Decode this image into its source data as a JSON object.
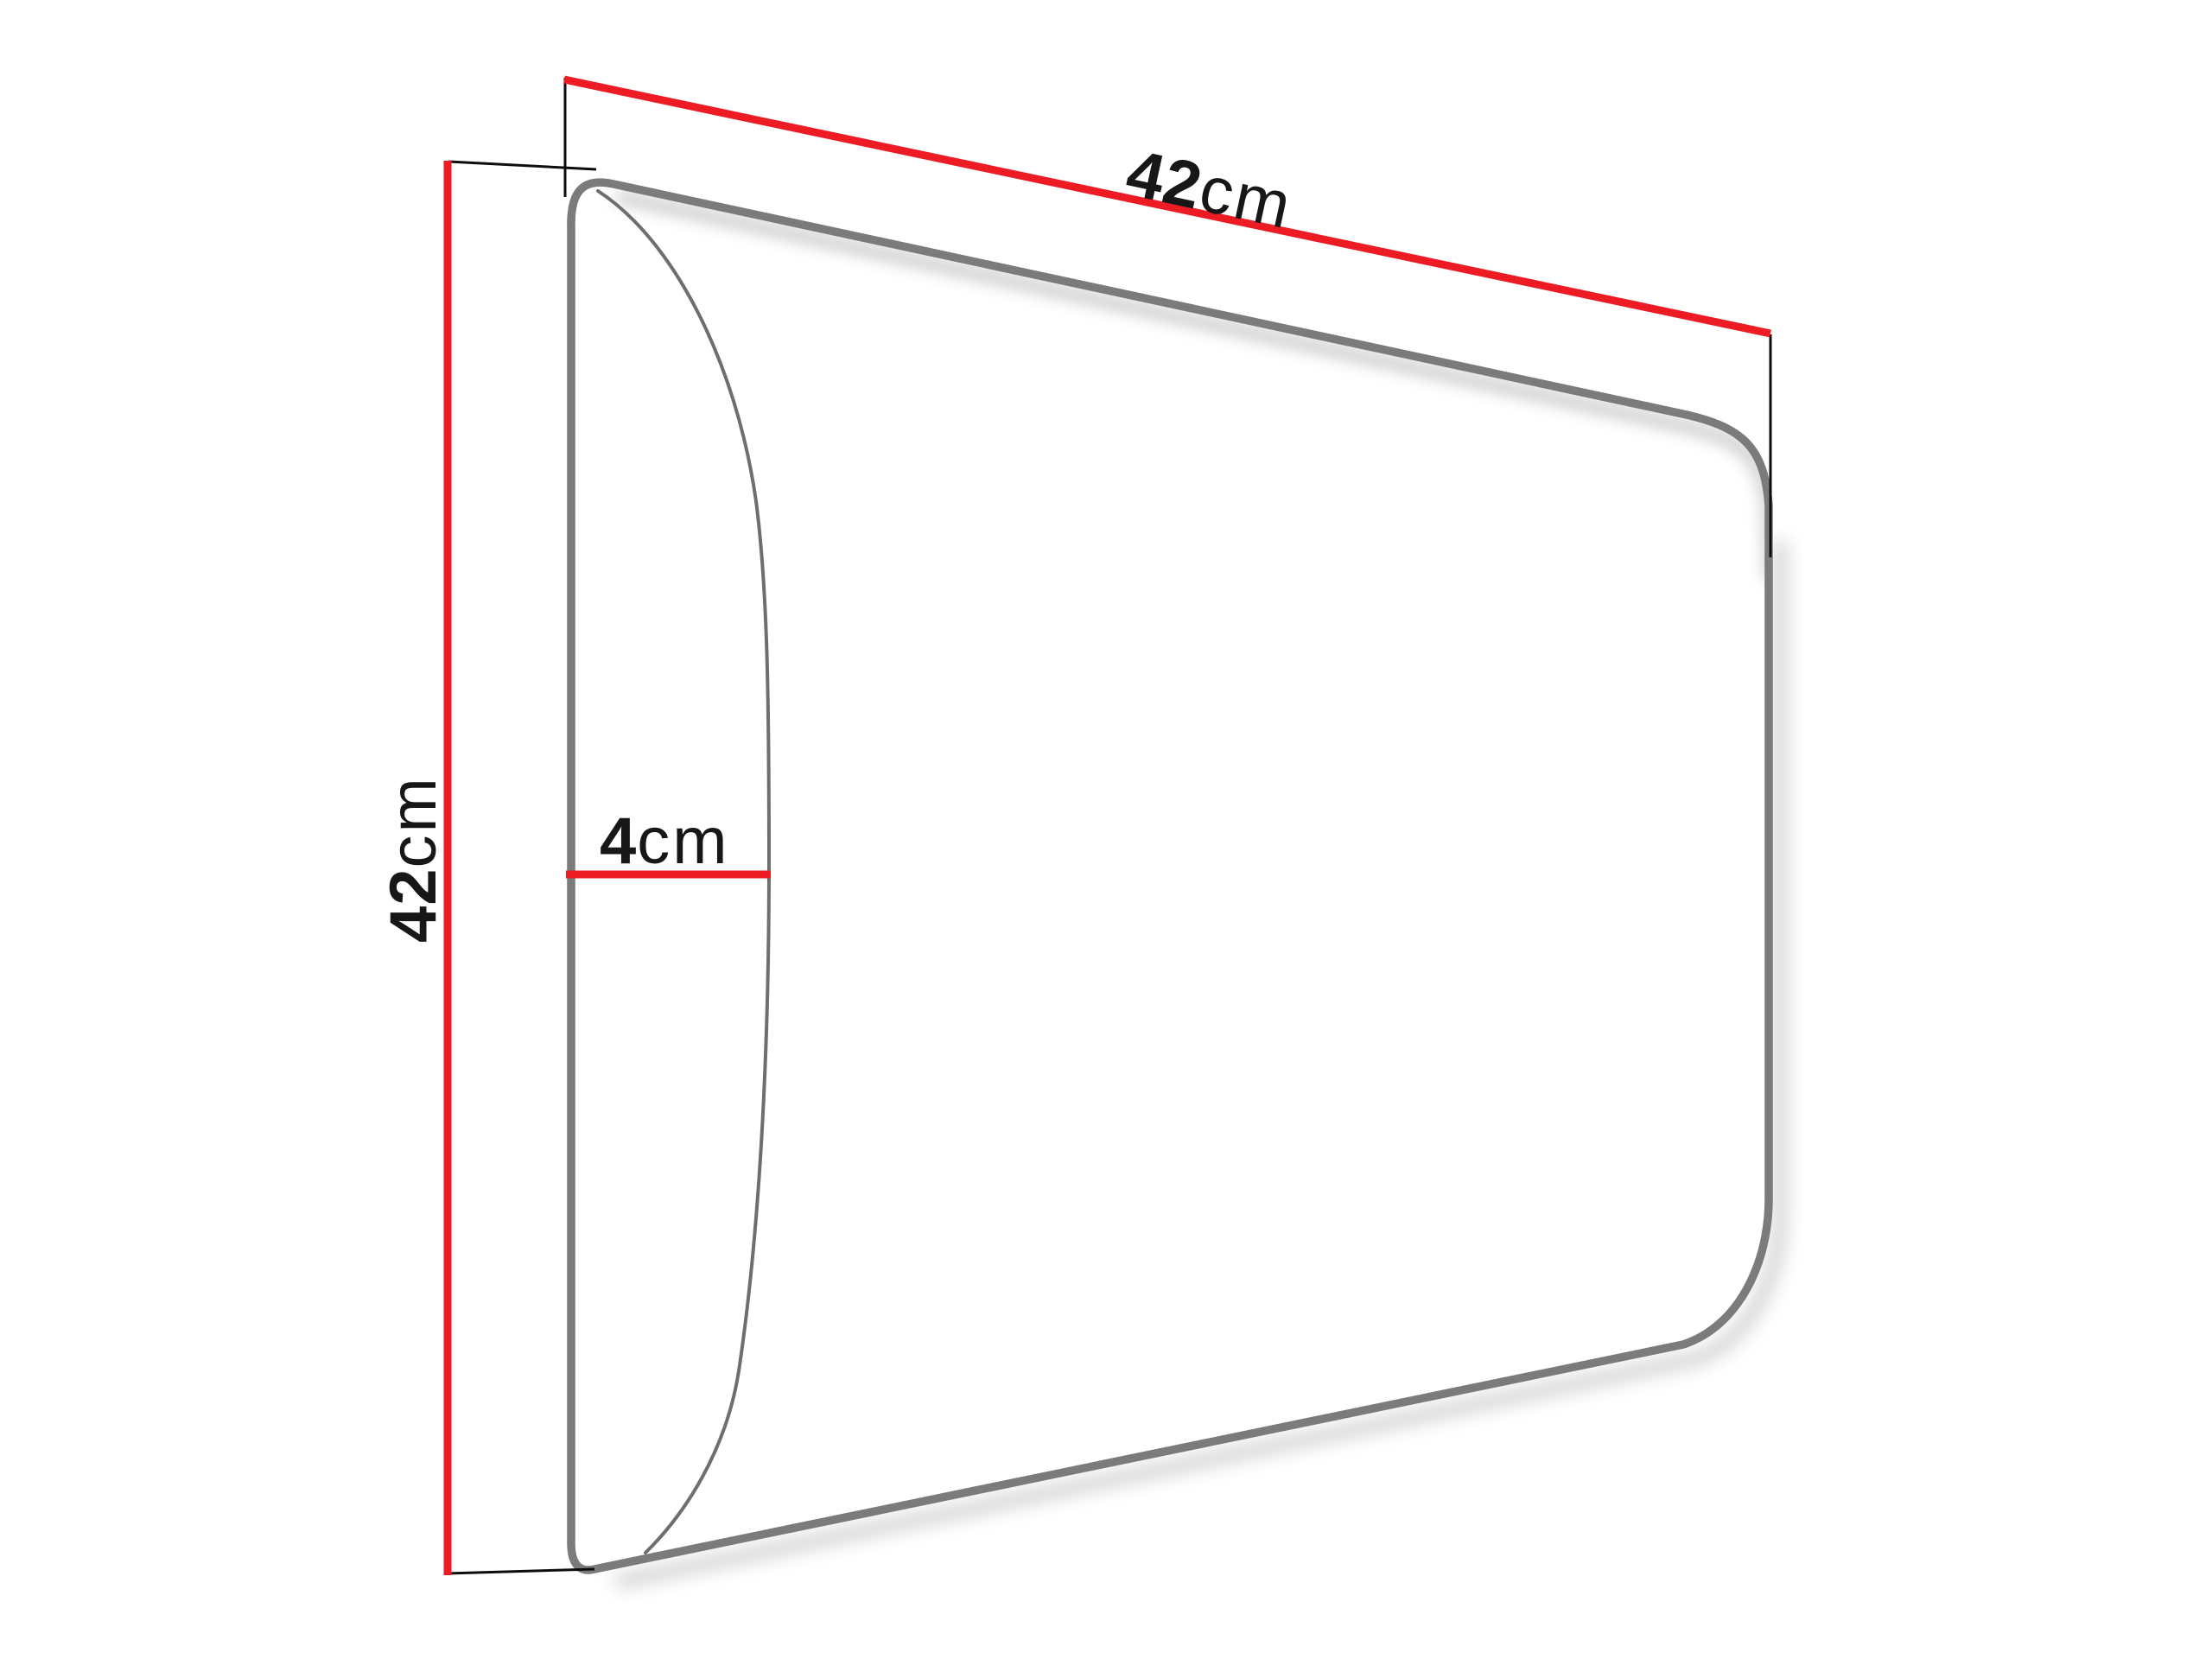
{
  "diagram": {
    "type": "upholstered-wall-panel-dimension-drawing",
    "background": "#ffffff",
    "dimensions": {
      "width": {
        "value": "42",
        "unit": "cm"
      },
      "height": {
        "value": "42",
        "unit": "cm"
      },
      "depth": {
        "value": "4",
        "unit": "cm"
      }
    },
    "colors": {
      "dimension_line": "#ed1c24",
      "panel_outline": "#7b7b7b",
      "front_edge_curve": "#6e6e6e",
      "extension_line": "#0d0d0d",
      "label_text": "#171717",
      "shadow": "#c9c9c9"
    }
  }
}
